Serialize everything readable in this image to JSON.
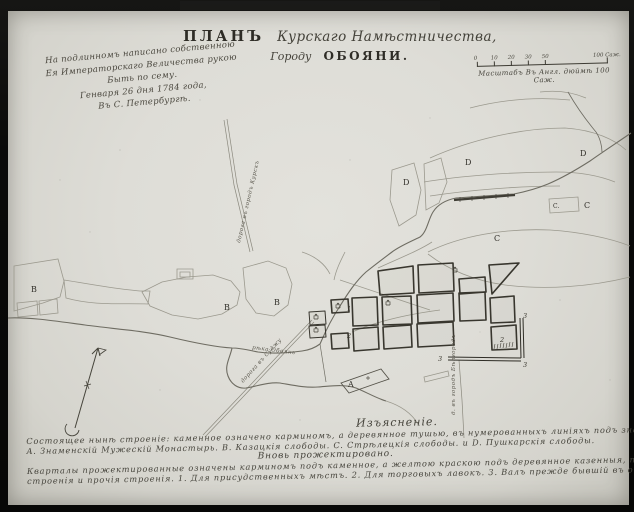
{
  "title": {
    "word_plan": "ПЛАНЪ",
    "script": "Курскаго Намѣстничества,",
    "line2_word": "Городу",
    "line2_city": "ОБОЯНИ."
  },
  "imperial_note": {
    "lines": [
      "На подлинномъ написано собственною",
      "Ея Императорскаго Величества рукою",
      "Быть по сему.",
      "Генваря 26 дня 1784 года,",
      "Въ С. Петербургѣ."
    ]
  },
  "scale_bar": {
    "tick_labels": [
      "0",
      "10",
      "20",
      "30",
      "50"
    ],
    "end_label": "100 Саж.",
    "caption": "Масштабъ Въ Англ. дюймѣ 100 Саж."
  },
  "legend": {
    "heading": "Изъясненіе.",
    "subheading": "Вновь прожектировано.",
    "lines": [
      "Состоящее нынѣ строеніе: каменное означено карминомъ, а деревянное тушью, въ нумерованныхъ линіяхъ подъ знакомъ ц. Церкви.",
      "A. Знаменскій Мужескій Монастырь. B. Казацкія слободы. C. Стрѣлецкія слободы. и D. Пушкарскія слободы.",
      "Кварталы прожектированные означены карминомъ подъ каменное, а желтою краскою подъ деревянное казенныя, публичныя и обывательскія",
      "строенія и прочія строенія. 1. Для присудственныхъ мѣстъ. 2. Для торговыхъ лавокъ. 3. Валъ прежде бывшій въ ограниченіи города."
    ]
  },
  "map": {
    "markers": [
      {
        "label": "B",
        "x": 31,
        "y": 292
      },
      {
        "label": "B",
        "x": 224,
        "y": 310
      },
      {
        "label": "B",
        "x": 274,
        "y": 305
      },
      {
        "label": "D",
        "x": 403,
        "y": 185
      },
      {
        "label": "D",
        "x": 465,
        "y": 165
      },
      {
        "label": "D",
        "x": 580,
        "y": 156
      },
      {
        "label": "C",
        "x": 494,
        "y": 241
      },
      {
        "label": "C.",
        "x": 553,
        "y": 208,
        "cls": "small"
      },
      {
        "label": "C",
        "x": 584,
        "y": 208
      },
      {
        "label": "A",
        "x": 348,
        "y": 387
      },
      {
        "label": "1",
        "x": 347,
        "y": 311,
        "cls": "num"
      },
      {
        "label": "2",
        "x": 347,
        "y": 338,
        "cls": "num"
      },
      {
        "label": "2",
        "x": 500,
        "y": 342,
        "cls": "num"
      },
      {
        "label": "3",
        "x": 523,
        "y": 318,
        "cls": "num"
      },
      {
        "label": "3",
        "x": 438,
        "y": 361,
        "cls": "num"
      },
      {
        "label": "3",
        "x": 523,
        "y": 367,
        "cls": "num"
      }
    ],
    "path_labels": [
      {
        "text": "дорога въ городъ Курскъ",
        "x": 240,
        "y": 243,
        "rotate": -77
      },
      {
        "text": "д. въ городъ Бѣлгородъ",
        "x": 455,
        "y": 415,
        "rotate": -90
      },
      {
        "text": "рѣка Обоянь",
        "x": 252,
        "y": 349,
        "rotate": 7
      },
      {
        "text": "дорога въ Суджу",
        "x": 243,
        "y": 383,
        "rotate": -48
      }
    ]
  },
  "colors": {
    "paper": "#deddd7",
    "ink": "#32302a",
    "faint_line": "#9b998e",
    "river": "#6e6c62",
    "frame": "#0b0b0a"
  }
}
